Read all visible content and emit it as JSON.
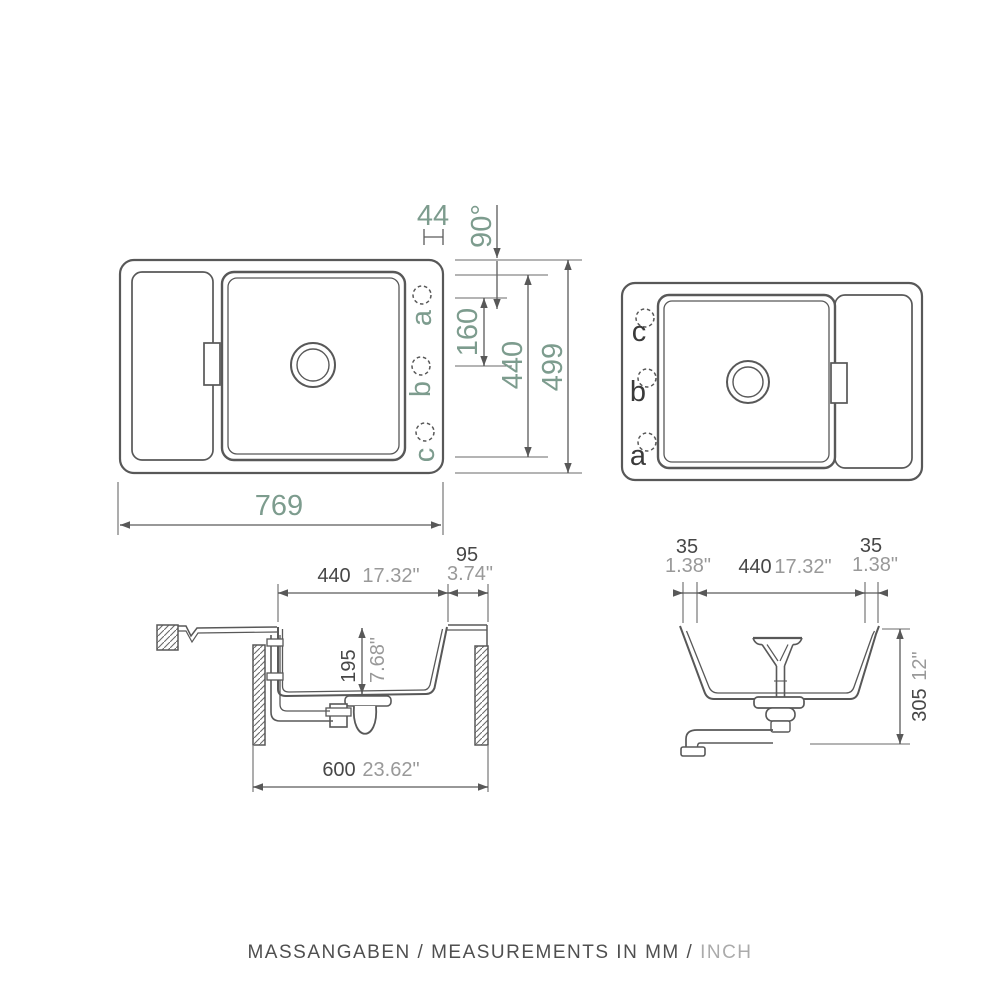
{
  "colors": {
    "line": "#585858",
    "dim_text_green": "#7d9c8e",
    "dim_text_dark": "#474747",
    "dim_text_gray": "#999999",
    "background": "#ffffff"
  },
  "top_view_left": {
    "hole_a": "a",
    "hole_b": "b",
    "hole_c": "c",
    "dim_hole_offset": "44",
    "dim_corner_angle": "90°",
    "dim_hole_spacing": "160",
    "dim_bowl_length": "440",
    "dim_overall_depth": "499",
    "dim_overall_width": "769"
  },
  "top_view_right": {
    "hole_a": "a",
    "hole_b": "b",
    "hole_c": "c"
  },
  "side_section": {
    "dim_bowl_width_mm": "440",
    "dim_bowl_width_in": "17.32\"",
    "dim_rim_mm": "95",
    "dim_rim_in": "3.74\"",
    "dim_bowl_depth_mm": "195",
    "dim_bowl_depth_in": "7.68\"",
    "dim_cabinet_mm": "600",
    "dim_cabinet_in": "23.62\""
  },
  "front_section": {
    "dim_left_clearance_mm": "35",
    "dim_left_clearance_in": "1.38\"",
    "dim_bowl_width_mm": "440",
    "dim_bowl_width_in": "17.32\"",
    "dim_right_clearance_mm": "35",
    "dim_right_clearance_in": "1.38\"",
    "dim_install_height_mm": "305",
    "dim_install_height_in": "12\""
  },
  "caption": {
    "text_mm": "MASSANGABEN / MEASUREMENTS IN MM / ",
    "text_inch": "INCH"
  }
}
